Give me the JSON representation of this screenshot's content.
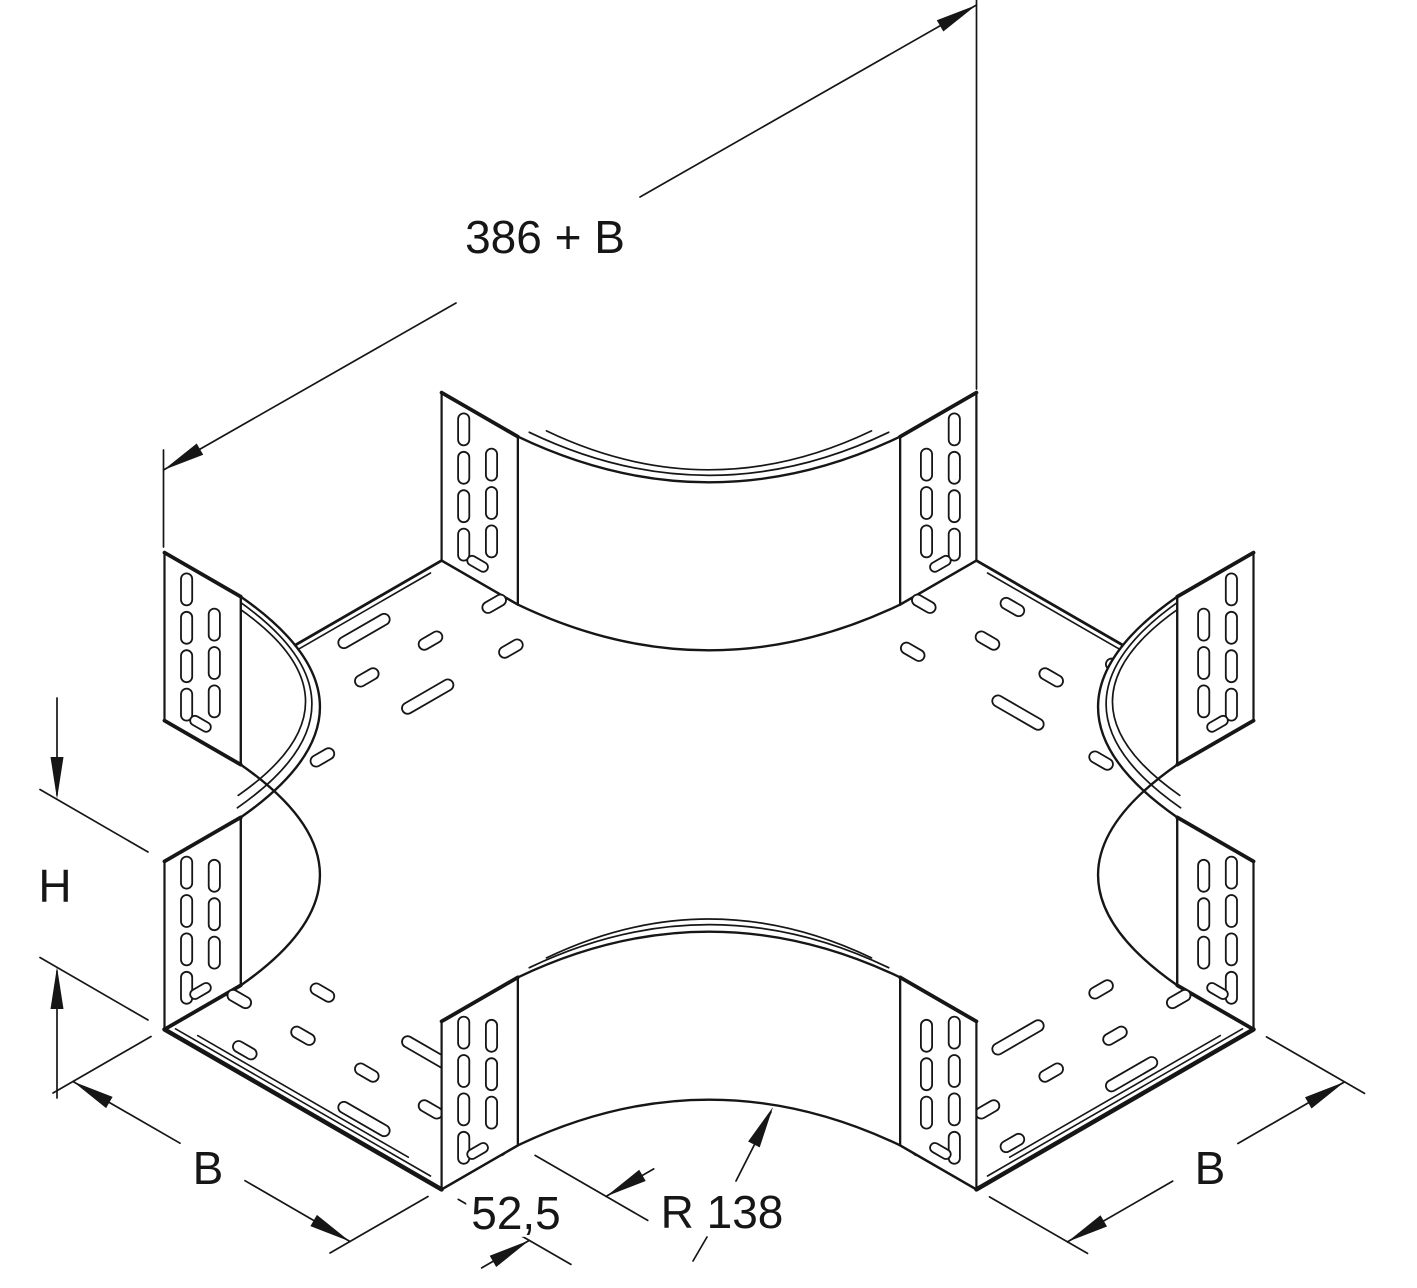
{
  "figure": {
    "type": "technical-line-drawing",
    "subject": "Cable tray cross piece (X-junction), isometric view with perforated side rails and connector tabs",
    "background": "#ffffff",
    "line_color": "#161616"
  },
  "dimensions": {
    "length_total": {
      "text": "386 + B"
    },
    "height": {
      "text": "H"
    },
    "width_left": {
      "text": "B"
    },
    "width_right": {
      "text": "B"
    },
    "tangent": {
      "text": "52,5"
    },
    "radius": {
      "text": "R 138"
    }
  },
  "label_positions": {
    "length_total": {
      "x": 545,
      "y": 237
    },
    "height": {
      "x": 55,
      "y": 886
    },
    "width_left": {
      "x": 208,
      "y": 1168
    },
    "width_right": {
      "x": 1210,
      "y": 1168
    },
    "tangent": {
      "x": 516,
      "y": 1213
    },
    "radius": {
      "x": 722,
      "y": 1212
    }
  },
  "geometry": {
    "canvas": {
      "width": 1417,
      "height": 1288
    },
    "scale": 1.6,
    "cx": 709,
    "cy": 875,
    "half_width": 100,
    "radius": 138,
    "tangent": 55,
    "half_length": 293,
    "rail_height": 105,
    "fillets": [
      {
        "id": "N",
        "e1": [
          100,
          -238
        ],
        "e2": [
          238,
          -100
        ],
        "mid": [
          140.4,
          -140.4
        ],
        "lip": [
          0,
          -7
        ]
      },
      {
        "id": "W",
        "e1": [
          -238,
          -100
        ],
        "e2": [
          -100,
          -238
        ],
        "mid": [
          -140.4,
          -140.4
        ],
        "lip": [
          -8,
          -3
        ]
      },
      {
        "id": "E",
        "e1": [
          238,
          100
        ],
        "e2": [
          100,
          238
        ],
        "mid": [
          140.4,
          140.4
        ],
        "lip": [
          8,
          -3
        ]
      },
      {
        "id": "S",
        "e1": [
          -238,
          100
        ],
        "e2": [
          -100,
          238
        ],
        "mid": [
          -140.4,
          140.4
        ],
        "lip": [
          0,
          -7
        ]
      }
    ],
    "tabs": [
      {
        "F": [
          -100,
          -293
        ],
        "d": [
          0,
          1
        ],
        "bt": 1
      },
      {
        "F": [
          -293,
          -100
        ],
        "d": [
          1,
          0
        ],
        "bt": 1
      },
      {
        "F": [
          100,
          -293
        ],
        "d": [
          0,
          1
        ],
        "bt": 0
      },
      {
        "F": [
          293,
          -100
        ],
        "d": [
          -1,
          0
        ],
        "bt": 0
      },
      {
        "F": [
          293,
          100
        ],
        "d": [
          -1,
          0
        ],
        "bt": 1
      },
      {
        "F": [
          100,
          293
        ],
        "d": [
          0,
          -1
        ],
        "bt": 1
      },
      {
        "F": [
          -293,
          100
        ],
        "d": [
          1,
          0
        ],
        "bt": 0
      },
      {
        "F": [
          -100,
          293
        ],
        "d": [
          0,
          -1
        ],
        "bt": 0
      }
    ],
    "tab_slots": {
      "col1_w": 16,
      "col1_z": [
        90,
        66,
        42,
        18
      ],
      "col2_w": 36,
      "col2_z": [
        78,
        54,
        30
      ],
      "hslot": {
        "w": 26,
        "z": 11,
        "len": 14,
        "wid": 6
      },
      "slot_h": 20,
      "slot_w": 7
    },
    "floor_rows": [
      {
        "D": 16,
        "items": [
          {
            "T": 28,
            "len": 36
          },
          {
            "T": -58,
            "len": 16
          }
        ]
      },
      {
        "D": 46,
        "items": [
          {
            "T": -92,
            "len": 16
          },
          {
            "T": -46,
            "len": 16
          },
          {
            "T": 0,
            "len": 16
          },
          {
            "T": 46,
            "len": 16
          },
          {
            "T": 92,
            "len": 16
          }
        ]
      },
      {
        "D": 80,
        "items": [
          {
            "T": -66,
            "len": 16
          },
          {
            "T": 10,
            "len": 36
          },
          {
            "T": 70,
            "len": 16
          }
        ]
      }
    ],
    "arms": [
      {
        "id": "BL",
        "end": [
          [
            -100,
            -293
          ],
          [
            100,
            -293
          ]
        ],
        "inward": [
          0,
          1
        ],
        "trans": "X",
        "thick": 2.8,
        "par": [
          6
        ]
      },
      {
        "id": "BR",
        "end": [
          [
            293,
            -100
          ],
          [
            293,
            100
          ]
        ],
        "inward": [
          -1,
          0
        ],
        "trans": "Y",
        "thick": 2.8,
        "par": [
          6
        ]
      },
      {
        "id": "FL",
        "end": [
          [
            -293,
            -100
          ],
          [
            -293,
            100
          ]
        ],
        "inward": [
          1,
          0
        ],
        "trans": "Y",
        "thick": 4.5,
        "par": [
          -7,
          -13
        ]
      },
      {
        "id": "FR",
        "end": [
          [
            -100,
            293
          ],
          [
            100,
            293
          ]
        ],
        "inward": [
          0,
          -1
        ],
        "trans": "X",
        "thick": 4.5,
        "par": [
          -7,
          -13
        ]
      }
    ]
  }
}
